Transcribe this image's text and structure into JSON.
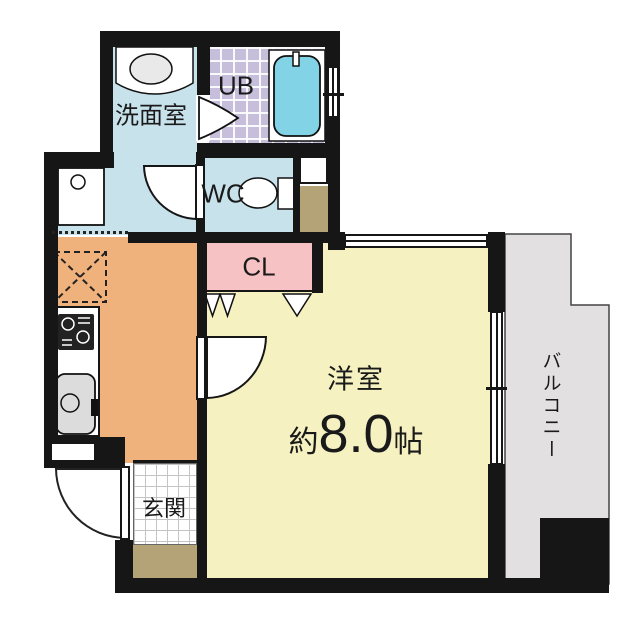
{
  "floor_plan": {
    "rooms": {
      "washroom": {
        "label": "洗面室"
      },
      "unit_bath": {
        "label": "UB"
      },
      "toilet": {
        "label": "WC"
      },
      "closet": {
        "label": "CL"
      },
      "western_room": {
        "label": "洋室",
        "size_prefix": "約",
        "size_value": "8.0",
        "size_unit": "帖",
        "size_full": "約8.0帖"
      },
      "entrance": {
        "label": "玄関"
      },
      "balcony": {
        "label": "バルコニー"
      }
    },
    "colors": {
      "wall": "#161616",
      "washroom_blue": "#c8e2ec",
      "bath_tile": "#c6bedb",
      "bathtub": "#82d3e6",
      "closet_pink": "#f6c2c3",
      "kitchen_orange": "#f0b27c",
      "room_yellow": "#f5f1c0",
      "balcony_gray": "#e2e0e0",
      "step_tan": "#b3a377"
    }
  }
}
